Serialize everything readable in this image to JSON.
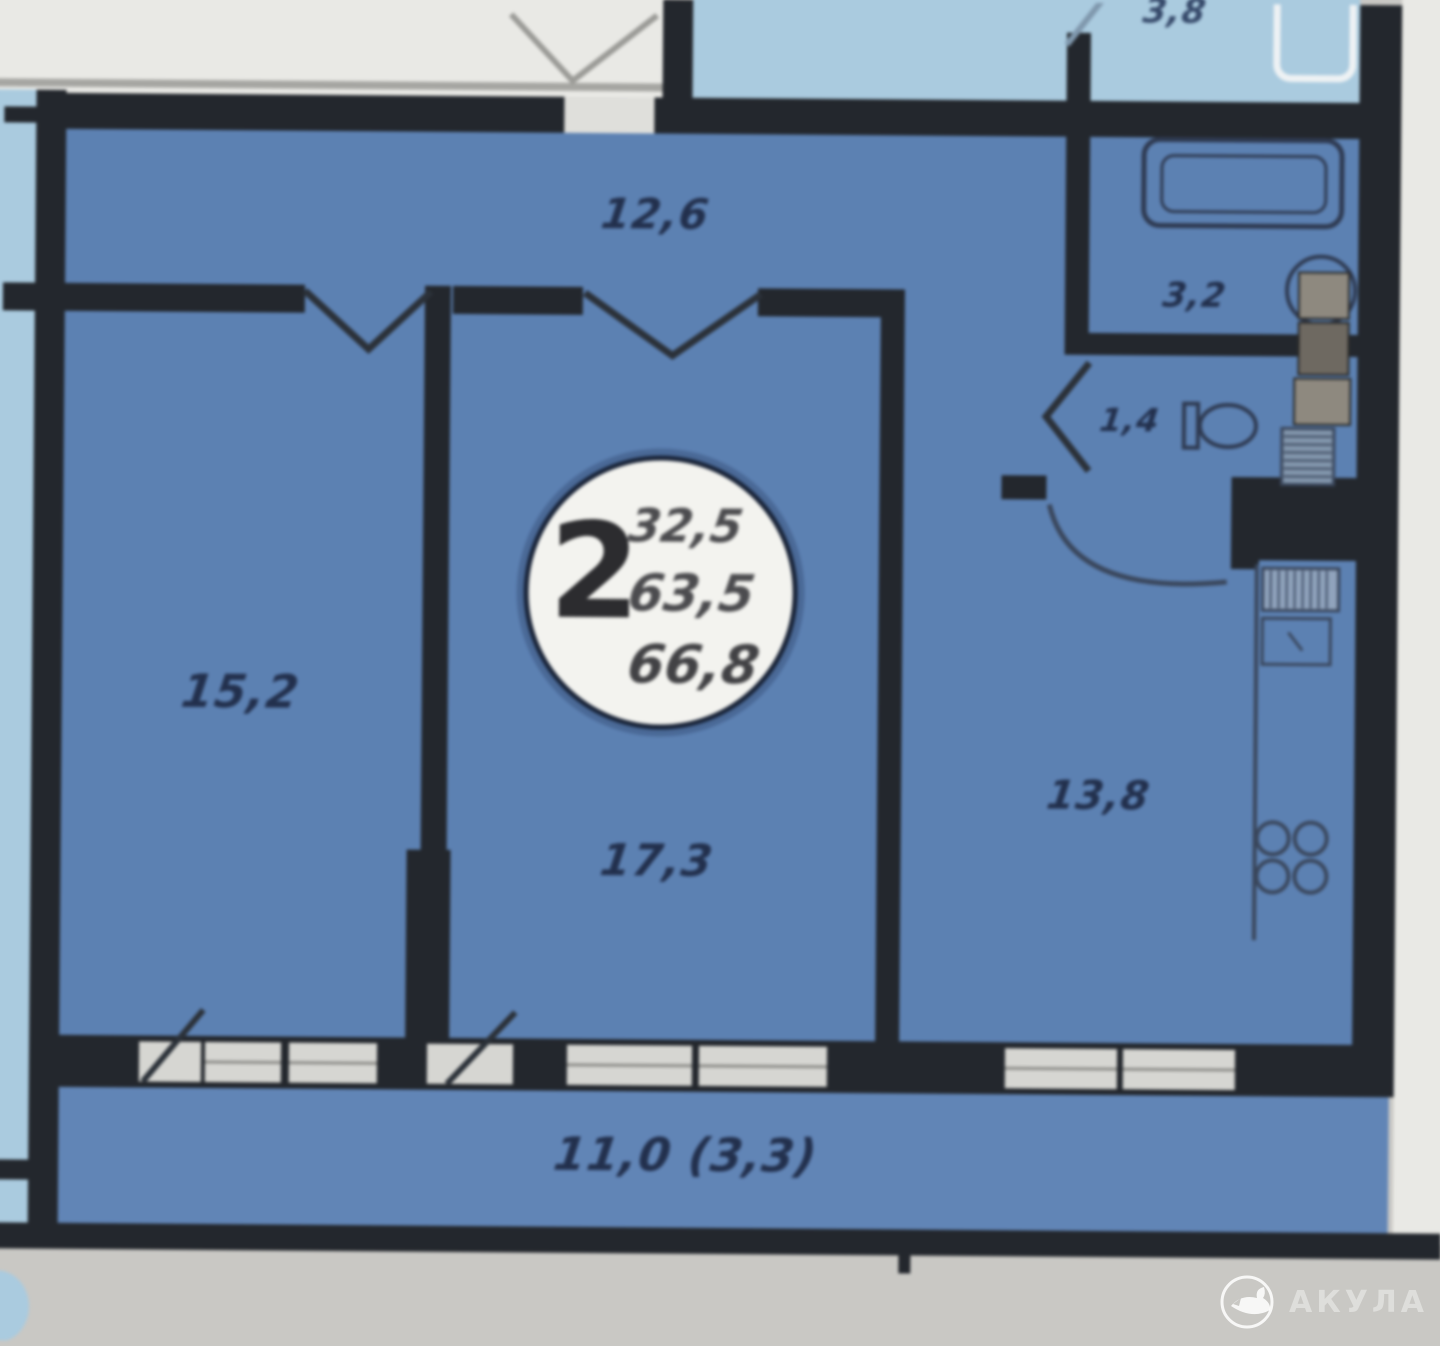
{
  "floorplan": {
    "badge": {
      "room_count": "2",
      "living_area": "32,5",
      "usable_area": "63,5",
      "total_area": "66,8"
    },
    "labels": {
      "hall": "12,6",
      "room_left": "15,2",
      "room_center": "17,3",
      "kitchen": "13,8",
      "bathroom": "3,2",
      "wc": "1,4",
      "balcony": "11,0 (3,3)",
      "neighbor_room": "3,8"
    },
    "watermark": "АКУЛА"
  },
  "colors": {
    "apartment_fill": "#5b81b4",
    "neighbor_fill": "#a9cbe0",
    "wall": "#23272d",
    "page": "#c9c8c4",
    "window": "#d6d6d2",
    "label_text": "#22304e"
  }
}
